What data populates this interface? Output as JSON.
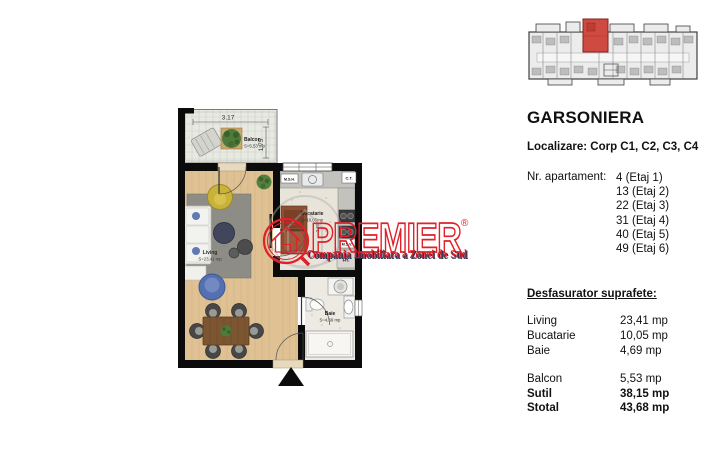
{
  "panel": {
    "title": "GARSONIERA",
    "localizare": "Localizare: Corp C1, C2, C3, C4",
    "apartments_label": "Nr. apartament:",
    "apartments": [
      "4 (Etaj 1)",
      "13 (Etaj 2)",
      "22 (Etaj 3)",
      "31 (Etaj 4)",
      "40 (Etaj 5)",
      "49 (Etaj 6)"
    ],
    "areas_heading": "Desfasurator suprafete:",
    "areas": [
      {
        "label": "Living",
        "value": "23,41 mp"
      },
      {
        "label": "Bucatarie",
        "value": "10,05 mp"
      },
      {
        "label": "Baie",
        "value": "4,69 mp"
      }
    ],
    "totals": [
      {
        "label": "Balcon",
        "value": "5,53 mp"
      },
      {
        "label": "Sutil",
        "value": "38,15 mp"
      },
      {
        "label": "Stotal",
        "value": "43,68 mp"
      }
    ]
  },
  "plan": {
    "balcony_label": "Balcon",
    "balcony_area": "S=5,53 mp",
    "living_label": "Living",
    "living_area": "S=23,41 mp",
    "kitchen_label": "Bucatarie",
    "kitchen_area": "S=10,05mp",
    "bath_label": "Baie",
    "bath_area": "S=4,69 mp",
    "dim_width": "3.17",
    "dim_depth": "1.75",
    "dim_kitchen": "2.85",
    "tag_msh": "M.S.H.",
    "tag_ct": "C.T.",
    "tag_msv": "M.S.V.",
    "tag_fr": "FR."
  },
  "watermark": {
    "brand": "PREMIER",
    "registered": "®",
    "tagline": "Compania Imobiliara a Zonei de Sud"
  },
  "colors": {
    "brand_red": "#e0202a",
    "unit_highlight": "#cf4b42",
    "wall_black": "#0b0b0b"
  }
}
